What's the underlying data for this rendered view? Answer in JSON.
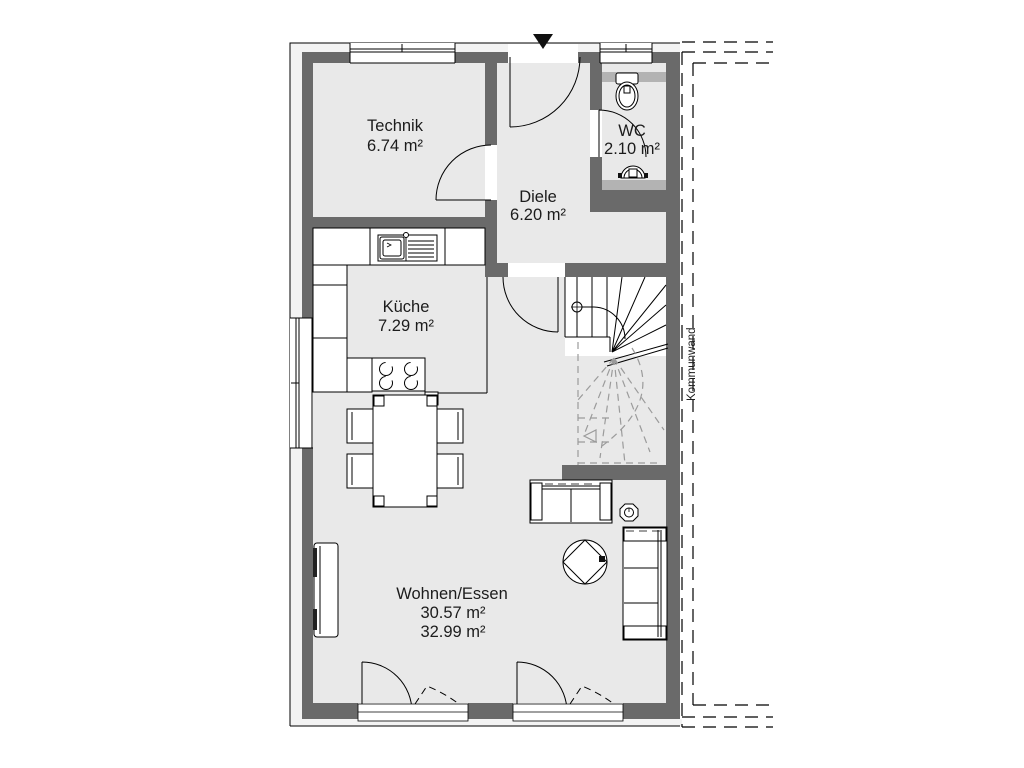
{
  "plan": {
    "rooms": [
      {
        "key": "technik",
        "label": "Technik",
        "area": "6.74 m²"
      },
      {
        "key": "diele",
        "label": "Diele",
        "area": "6.20 m²"
      },
      {
        "key": "wc",
        "label": "WC",
        "area": "2.10 m²"
      },
      {
        "key": "kueche",
        "label": "Küche",
        "area": "7.29 m²"
      },
      {
        "key": "wohnen",
        "label": "Wohnen/Essen",
        "area": "30.57 m²",
        "area_alt": "32.99 m²"
      }
    ],
    "party_wall_label": "Kommunwand",
    "colors": {
      "background": "#ffffff",
      "floor": "#e9e9e9",
      "wall": "#6a6a6a",
      "outer_leaf": "#f3f3f3",
      "sill": "#b3b3b3",
      "line": "#000000",
      "stair_dash": "#9b9b9b"
    }
  }
}
